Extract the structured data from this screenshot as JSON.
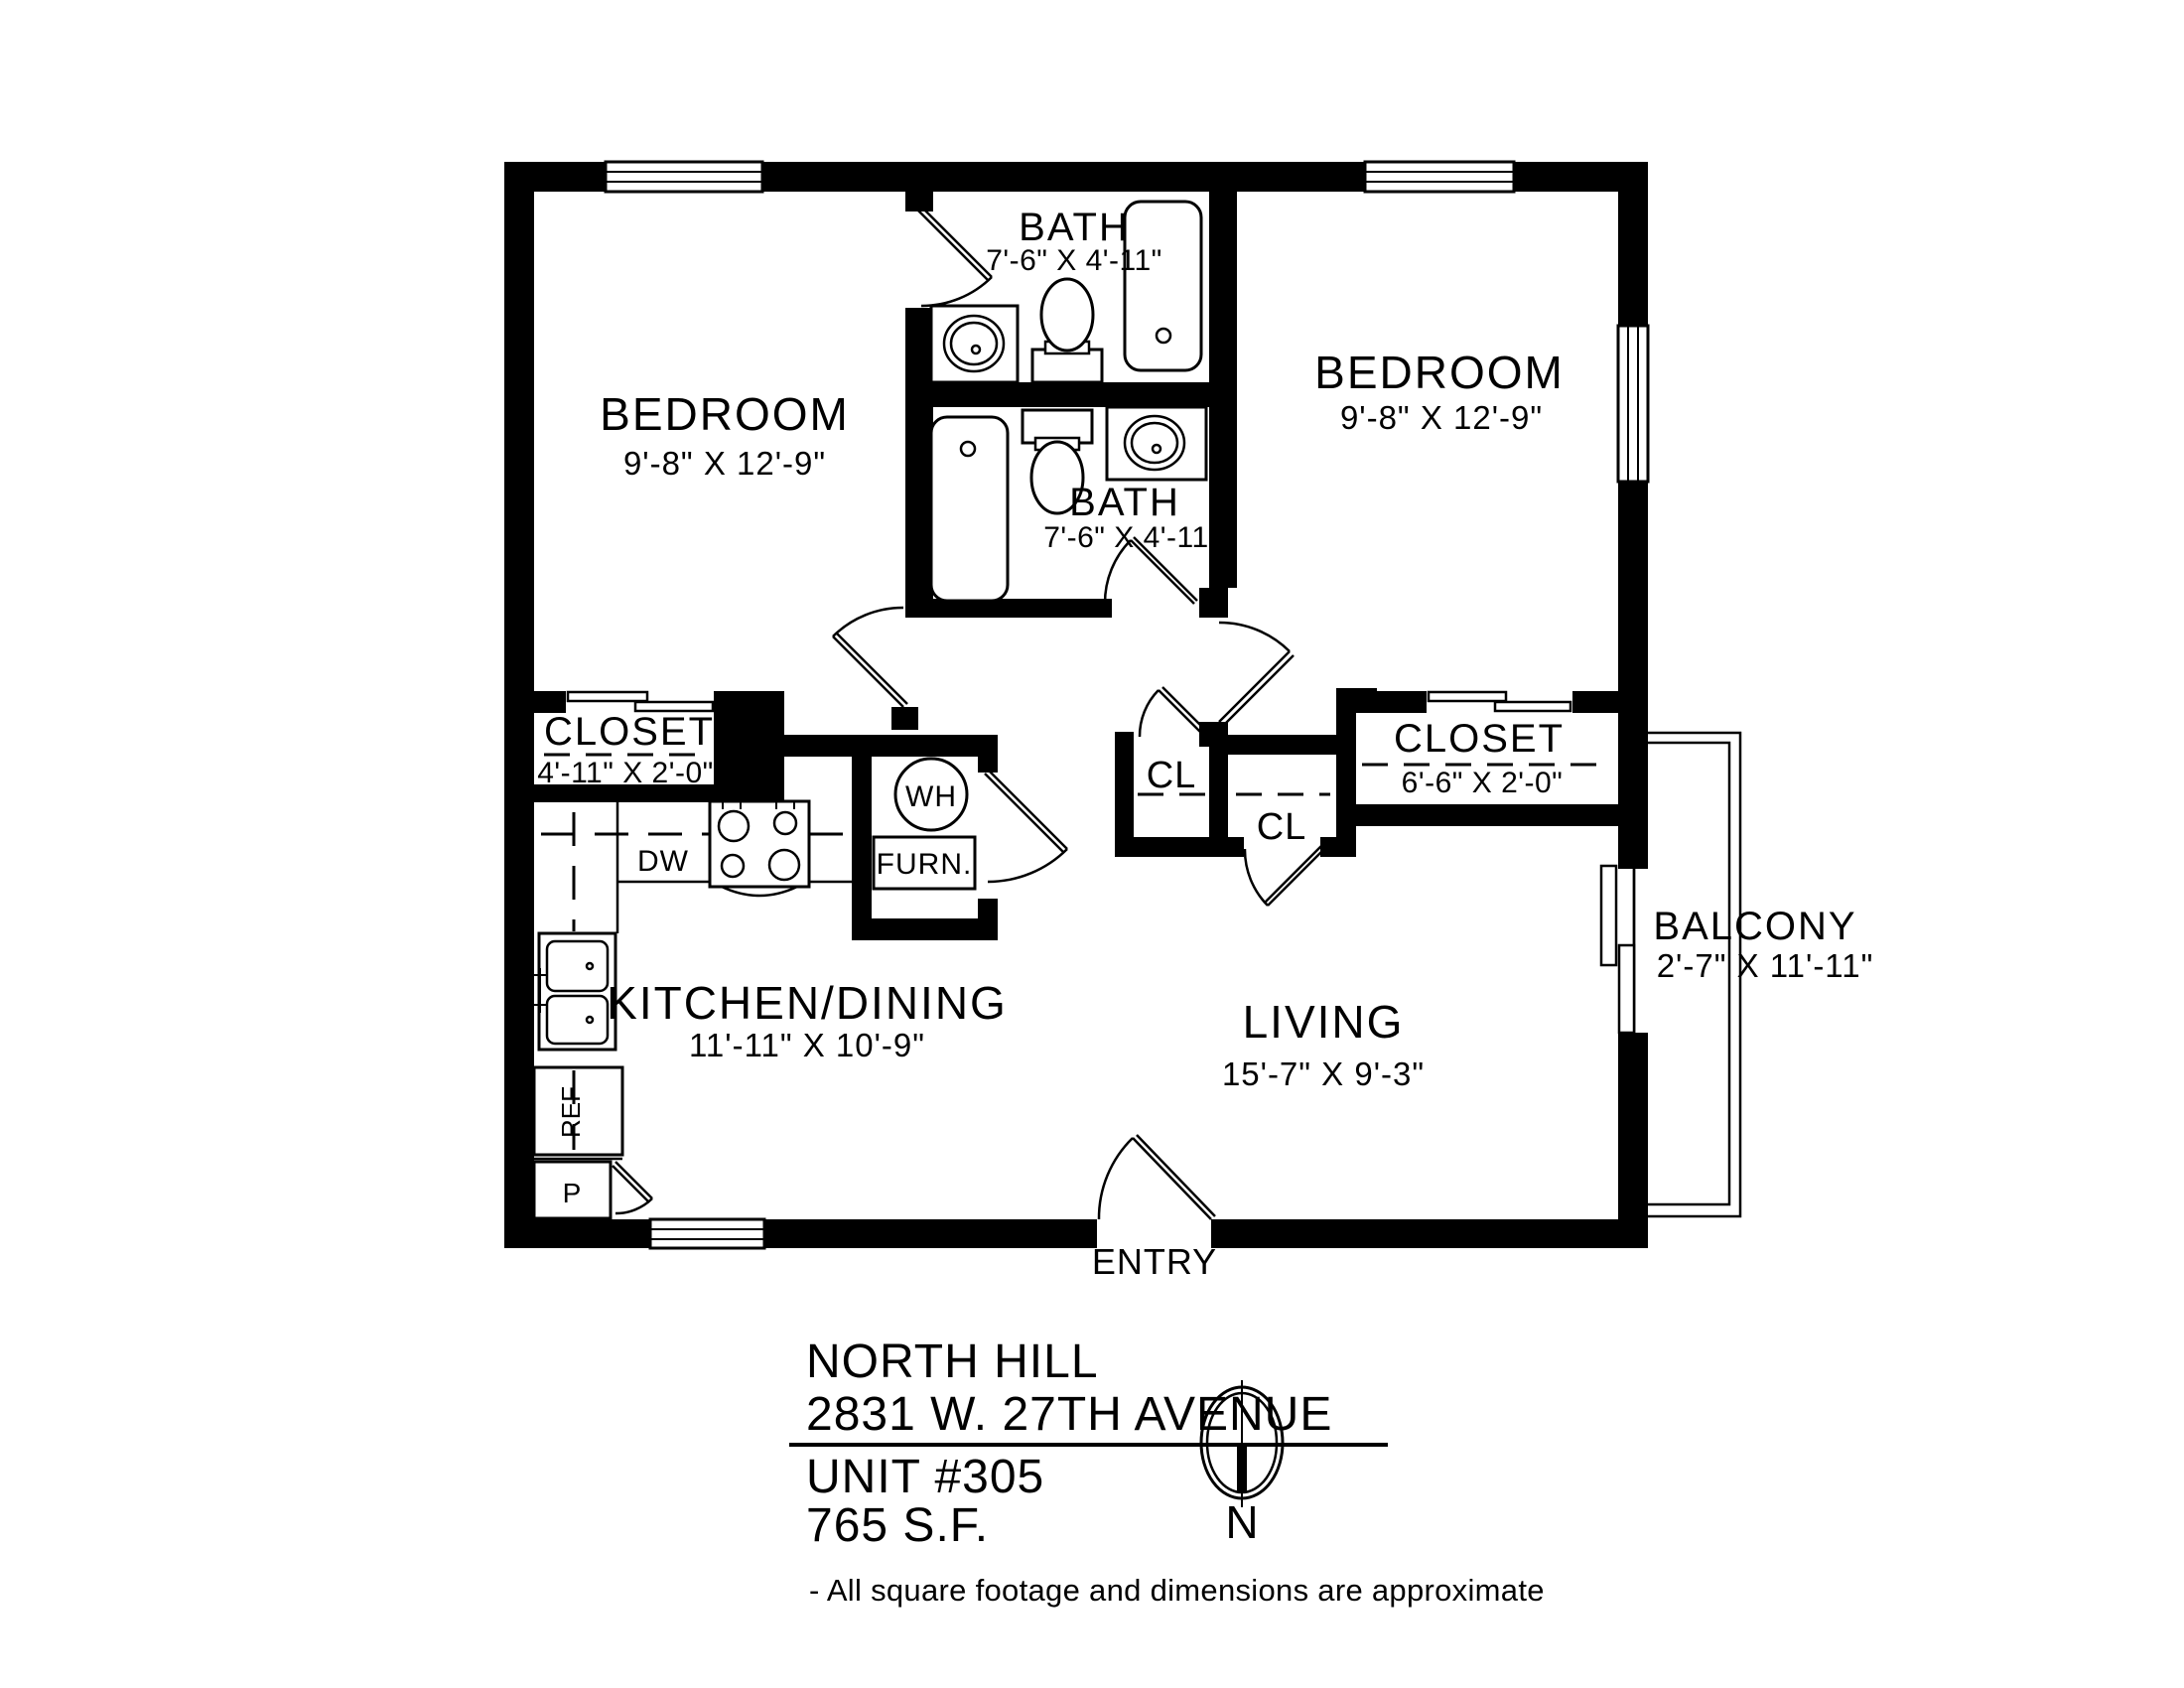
{
  "rooms": {
    "bedroom_left": {
      "name": "BEDROOM",
      "dims": "9'-8\" X 12'-9\""
    },
    "bedroom_right": {
      "name": "BEDROOM",
      "dims": "9'-8\" X 12'-9\""
    },
    "bath_top": {
      "name": "BATH",
      "dims": "7'-6\" X 4'-11\""
    },
    "bath_bottom": {
      "name": "BATH",
      "dims": "7'-6\" X 4'-11\""
    },
    "closet_left": {
      "name": "CLOSET",
      "dims": "4'-11\" X 2'-0\""
    },
    "closet_right": {
      "name": "CLOSET",
      "dims": "6'-6\" X 2'-0\""
    },
    "cl_hall": {
      "name": "CL"
    },
    "cl_living": {
      "name": "CL"
    },
    "kitchen": {
      "name": "KITCHEN/DINING",
      "dims": "11'-11\" X 10'-9\""
    },
    "living": {
      "name": "LIVING",
      "dims": "15'-7\" X 9'-3\""
    },
    "balcony": {
      "name": "BALCONY",
      "dims": "2'-7\" X 11'-11\""
    },
    "entry": {
      "name": "ENTRY"
    }
  },
  "fixtures": {
    "water_heater": "WH",
    "furnace": "FURN.",
    "dishwasher": "DW",
    "refrigerator": "REF",
    "pantry": "P"
  },
  "title_block": {
    "property_name": "NORTH HILL",
    "address": "2831 W. 27TH AVENUE",
    "unit": "UNIT #305",
    "area": "765 S.F.",
    "footnote": "- All square footage and dimensions are approximate",
    "compass_label": "N"
  },
  "colors": {
    "ink": "#000000",
    "paper": "#ffffff"
  }
}
